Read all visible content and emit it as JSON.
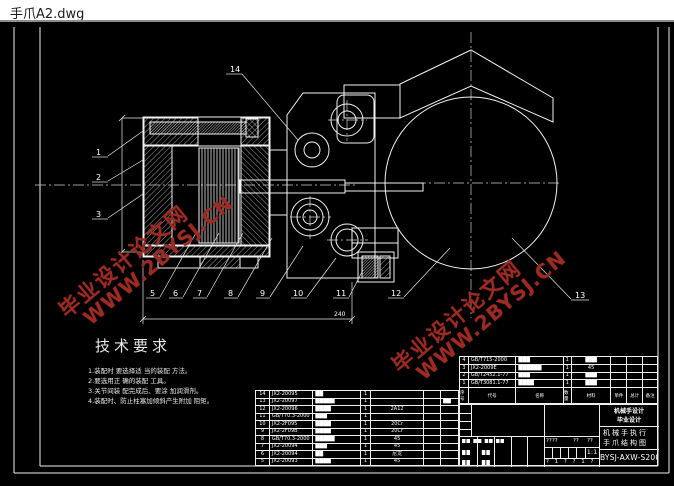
{
  "window": {
    "title": "手爪A2.dwg"
  },
  "watermark": {
    "line1": "毕业设计论文网",
    "line2": "WWW.2BYSJ.CN",
    "color": "#9c2b24"
  },
  "tech": {
    "heading": "技术要求",
    "items": [
      "1.装配时 要选择适 当的装配 方法。",
      "2.要选用正 确的装配 工具。",
      "3.关节间装 配完成后、要涂 加润滑剂。",
      "4.装配时、防止柱塞加倾斜产生附加 阻矩。"
    ]
  },
  "part_labels": {
    "n1": "1",
    "n2": "2",
    "n3": "3",
    "n5": "5",
    "n6": "6",
    "n7": "7",
    "n8": "8",
    "n9": "9",
    "n10": "10",
    "n11": "11",
    "n12": "12",
    "n13": "13",
    "n14": "14"
  },
  "dimensions": {
    "bottom_width": "240"
  },
  "bom_left": {
    "rows": [
      {
        "no": "14",
        "code": "JX2-20095",
        "name": "██",
        "qty": "1",
        "mat": "",
        "r1": "",
        "r2": ""
      },
      {
        "no": "13",
        "code": "JX2-20097",
        "name": "█████",
        "qty": "1",
        "mat": "",
        "r1": "",
        "r2": "██"
      },
      {
        "no": "12",
        "code": "JX2-20096",
        "name": "████",
        "qty": "1",
        "mat": "2A12",
        "r1": "",
        "r2": ""
      },
      {
        "no": "11",
        "code": "GB/T70.3-2000",
        "name": "███",
        "qty": "1",
        "mat": "",
        "r1": "",
        "r2": ""
      },
      {
        "no": "10",
        "code": "JX2-2F095",
        "name": "████",
        "qty": "1",
        "mat": "20Cr",
        "r1": "",
        "r2": ""
      },
      {
        "no": "9",
        "code": "JX2-2F09B",
        "name": "████",
        "qty": "1",
        "mat": "20Cr",
        "r1": "",
        "r2": ""
      },
      {
        "no": "8",
        "code": "GB/T70.3-2000",
        "name": "█████",
        "qty": "1",
        "mat": "45",
        "r1": "",
        "r2": ""
      },
      {
        "no": "7",
        "code": "JX2-20094",
        "name": "███",
        "qty": "1",
        "mat": "45",
        "r1": "",
        "r2": ""
      },
      {
        "no": "6",
        "code": "JX2-20094",
        "name": "██",
        "qty": "1",
        "mat": "尼龙",
        "r1": "",
        "r2": ""
      },
      {
        "no": "5",
        "code": "JX2-20093",
        "name": "████",
        "qty": "1",
        "mat": "45",
        "r1": "",
        "r2": ""
      }
    ]
  },
  "bom_right": {
    "headers": [
      "序号",
      "代号",
      "名称",
      "数量",
      "材料",
      "单件",
      "总计",
      "备注"
    ],
    "rows": [
      {
        "no": "4",
        "code": "GB/T715-2000",
        "name": "███",
        "qty": "1",
        "mat": "███",
        "r1": "",
        "r2": "",
        "r3": ""
      },
      {
        "no": "3",
        "code": "JX2-2009E",
        "name": "██████",
        "qty": "1",
        "mat": "45",
        "r1": "",
        "r2": "",
        "r3": ""
      },
      {
        "no": "2",
        "code": "GB/T2452.1-77",
        "name": "███",
        "qty": "1",
        "mat": "███",
        "r1": "",
        "r2": "",
        "r3": ""
      },
      {
        "no": "1",
        "code": "GB/T3081.1-77",
        "name": "████",
        "qty": "1",
        "mat": "███",
        "r1": "",
        "r2": "",
        "r3": ""
      }
    ]
  },
  "title_block": {
    "org_line1": "机械手设计",
    "org_line2": "毕业设计",
    "product_line1": "机械手执行",
    "product_line2": "手爪结构图",
    "drawing_no": "BYSJ-AXW-S2008",
    "scale": "1:1",
    "sig_row1_a": "????",
    "sig_row1_b": "??",
    "sig_row1_c": "??",
    "sig_row3": "? 1 ? ? 1 ?",
    "sig_left_row1": "██ ██ ██ ██",
    "sig_left_row2": "██　　██",
    "sig_left_row3": "██　　██"
  }
}
